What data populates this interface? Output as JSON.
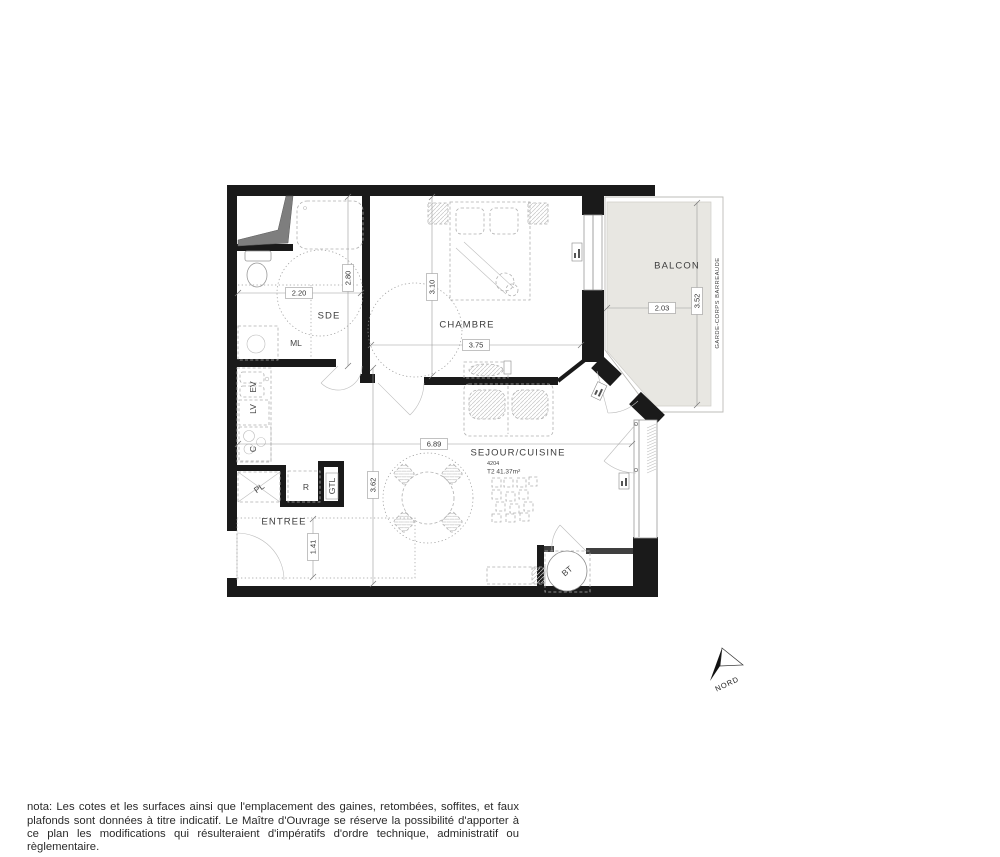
{
  "colors": {
    "wall": "#1a1a1a",
    "balcony_fill": "#e8e7e2",
    "text": "#333333"
  },
  "plan": {
    "rooms": {
      "sde": "SDE",
      "chambre": "CHAMBRE",
      "sejour": "SEJOUR/CUISINE",
      "entree": "ENTREE",
      "balcon": "BALCON"
    },
    "unit": {
      "number": "4204",
      "type_surface": "T2 41.37m²"
    },
    "small_labels": {
      "ml": "ML",
      "ev": "EV",
      "lv": "LV",
      "c": "C",
      "pl": "PL",
      "r": "R",
      "gtl": "GTL",
      "bt": "BT"
    },
    "dims": {
      "sde_width": "2.20",
      "sde_depth": "2.80",
      "chambre_depth": "3.10",
      "chambre_width": "3.75",
      "sejour_width": "6.89",
      "sejour_depth": "3.62",
      "entree_depth": "1.41",
      "balcon_width": "2.03",
      "balcon_depth": "3.52"
    },
    "balcony_note": "GARDE-CORPS BARREAUDE",
    "north_label": "NORD"
  },
  "footer": {
    "nota": "nota: Les cotes et les surfaces ainsi que l'emplacement des gaines, retombées, soffites, et faux plafonds sont données à titre indicatif. Le Maître d'Ouvrage se réserve la possibilité d'apporter à ce plan les modifications qui résulteraient d'impératifs d'ordre technique, administratif ou règlementaire."
  }
}
